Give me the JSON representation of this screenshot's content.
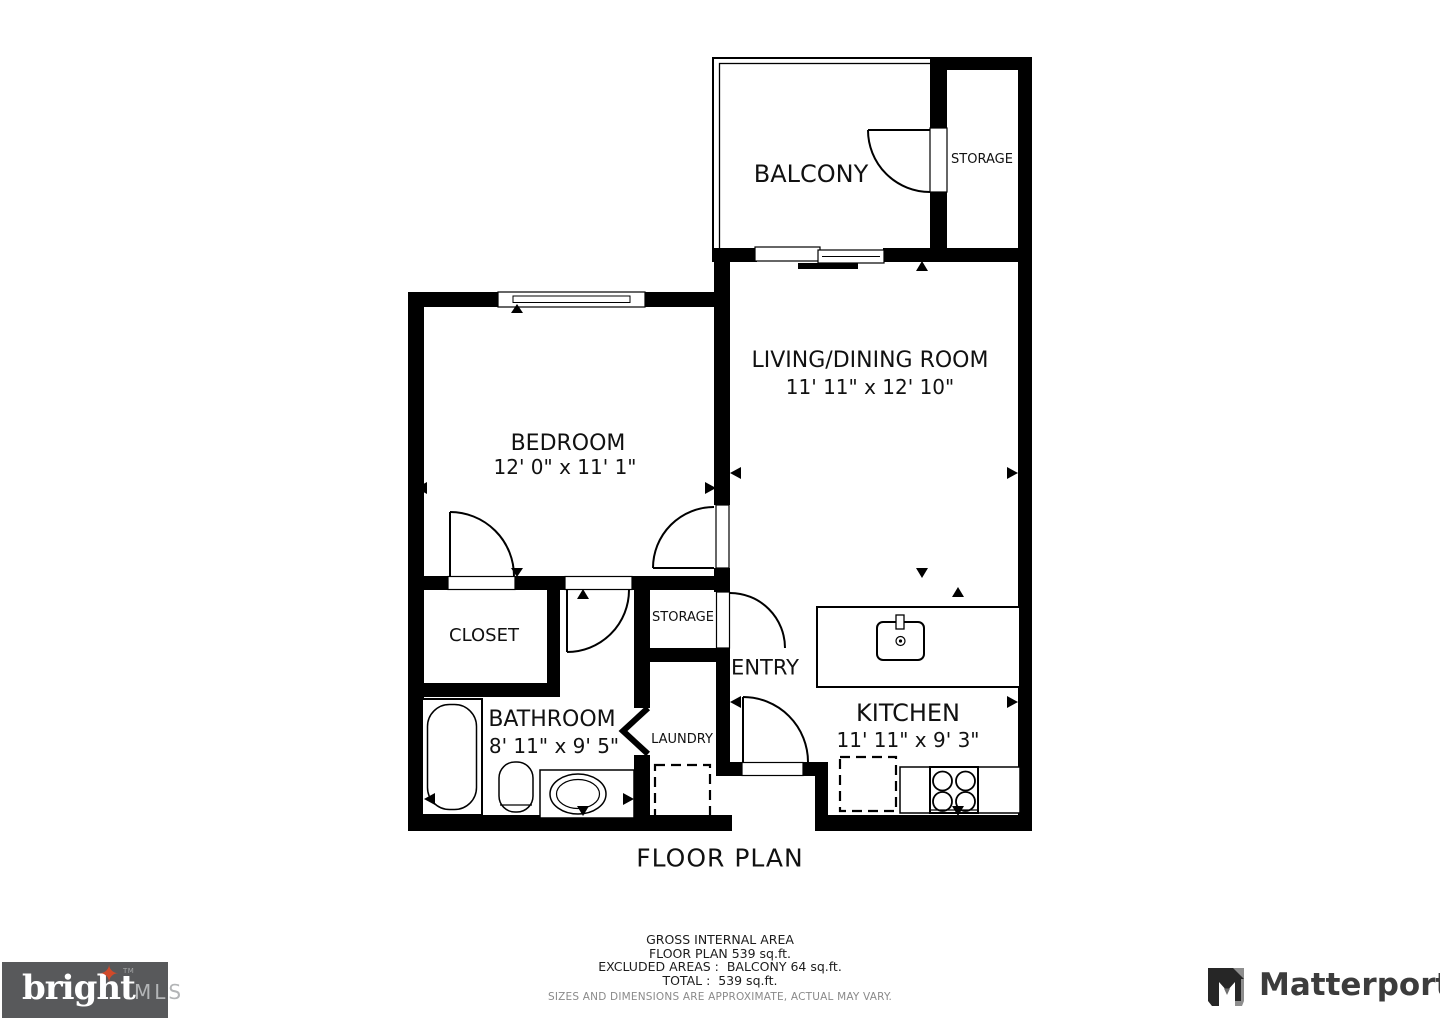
{
  "page": {
    "title": "FLOOR PLAN"
  },
  "rooms": {
    "balcony": {
      "name": "BALCONY"
    },
    "storage_upper": {
      "name": "STORAGE"
    },
    "living_dining": {
      "name": "LIVING/DINING ROOM",
      "dims": "11' 11\" x 12' 10\""
    },
    "bedroom": {
      "name": "BEDROOM",
      "dims": "12' 0\" x 11' 1\""
    },
    "closet": {
      "name": "CLOSET"
    },
    "storage_hall": {
      "name": "STORAGE"
    },
    "entry": {
      "name": "ENTRY"
    },
    "bathroom": {
      "name": "BATHROOM",
      "dims": "8' 11\" x 9' 5\""
    },
    "laundry": {
      "name": "LAUNDRY"
    },
    "kitchen": {
      "name": "KITCHEN",
      "dims": "11' 11\" x 9' 3\""
    }
  },
  "footer": {
    "area_title": "GROSS INTERNAL AREA",
    "floor_plan_area": "FLOOR PLAN 539 sq.ft.",
    "excluded": "EXCLUDED AREAS :  BALCONY 64 sq.ft.",
    "total": "TOTAL :  539 sq.ft.",
    "disclaimer": "SIZES AND DIMENSIONS ARE APPROXIMATE, ACTUAL MAY VARY."
  },
  "logos": {
    "bright_mls": {
      "word": "bright",
      "suffix": "MLS",
      "tm": "TM",
      "bg_color": "#58595b",
      "star_color": "#d04a2a",
      "text_color": "#ffffff",
      "suffix_color": "#b3b5b7"
    },
    "matterport": {
      "text": "Matterport",
      "color": "#3c3c3c"
    }
  },
  "palette": {
    "walls": "#000000",
    "background": "#ffffff",
    "label_text": "#111111"
  }
}
